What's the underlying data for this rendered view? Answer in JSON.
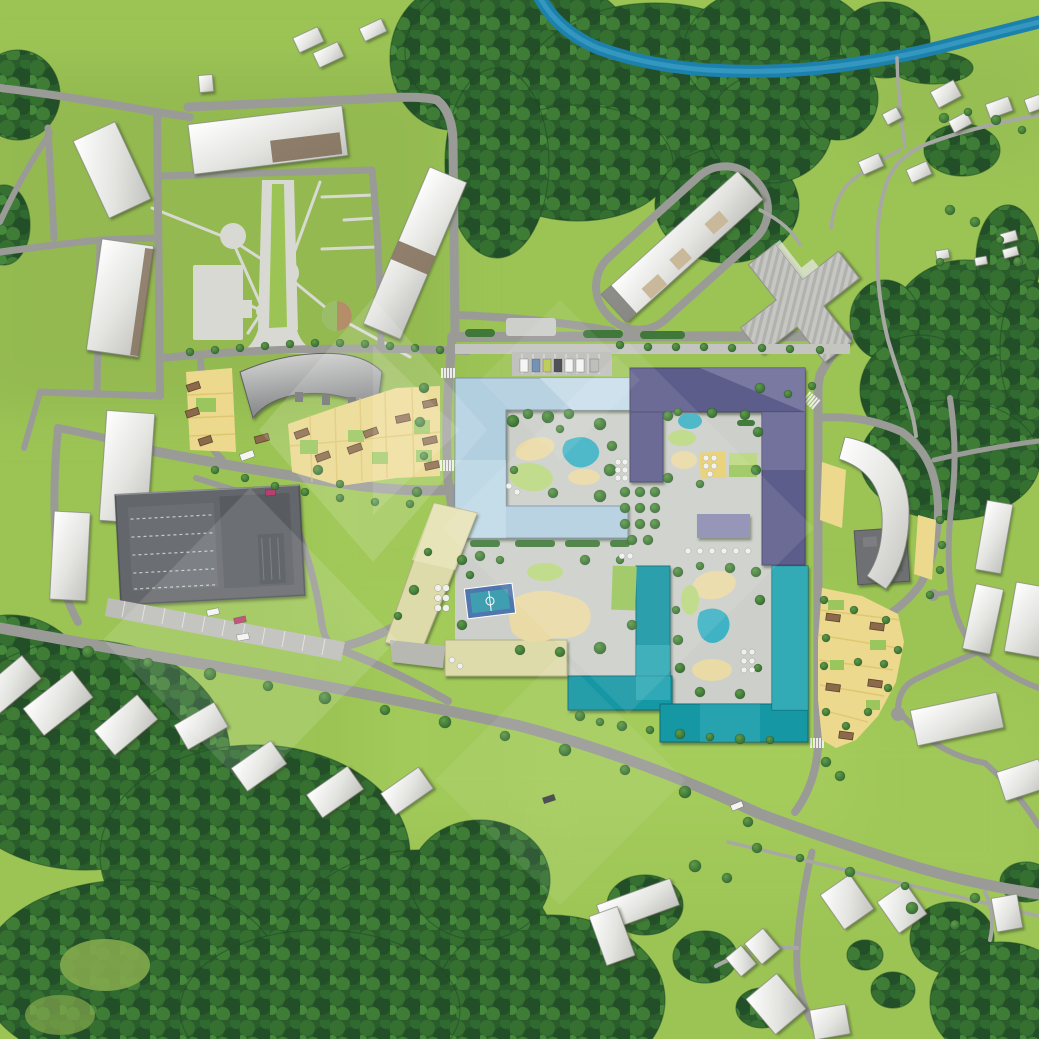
{
  "map": {
    "title": "residential-complex-masterplan-aerial-illustration",
    "text_labels": [],
    "palette": {
      "grass": "#9cc455",
      "grass_olive": "#8cb14e",
      "grass_bright": "#a9d05e",
      "meadow": "#83a84c",
      "forest": "#2b5c2c",
      "forest_dark": "#1f4a24",
      "tree": "#3f7d36",
      "hedge": "#3a7634",
      "river": "#1d81ae",
      "river_light": "#3fa3c8",
      "road": "#9a9b97",
      "lane": "#a7a8a4",
      "path": "#d8d9d3",
      "pavement": "#cdcfca",
      "sidewalk": "#c4c5c0",
      "apron": "#bcbdb9",
      "roof_white": "#eceded",
      "roof_edge": "#83847e",
      "roof_face": "#70716d",
      "roof_brown": "#7e6b55",
      "block_blue": "#b2cfe0",
      "block_blue_light": "#cadfeb",
      "block_purple": "#5d5d8b",
      "block_purple_light": "#8c8cb3",
      "block_teal": "#1297a4",
      "block_teal_light": "#54bfca",
      "block_yellow": "#dedbaa",
      "block_yellow_light": "#ece9c3",
      "wing_gray": "#b7b8b2",
      "townhouse": "#ecd98d",
      "townhouse_dark": "#dcc26c",
      "hut": "#8a6a4a",
      "hut_dark": "#5f452e",
      "garage": "#63666a",
      "garage_dark": "#4d5054",
      "garage_lines": "#c9cac6",
      "cross_building": "#c6c7c3",
      "cross_stripe": "#9fa09c",
      "school": "#6e7073",
      "pond": "#3fb2c4",
      "sand": "#e9daa6",
      "lawn": "#9ac65e",
      "lawn_light": "#bcd983",
      "play_yellow": "#e7cf6e",
      "court_blue": "#4f76ad",
      "court_teal": "#3f9fb0",
      "dot": "#f0f1ee",
      "car_white": "#f4f5f3",
      "car_dark": "#41434a",
      "car_blue": "#6a88b0",
      "car_lime": "#b9c94e",
      "car_red": "#b8406e",
      "car_gray": "#b9bab6",
      "watermark": "#ffffff"
    },
    "districts": {
      "new_residential_complex": {
        "blocks": [
          {
            "id": "north-block",
            "roof_color": "light-blue"
          },
          {
            "id": "east-block",
            "roof_color": "purple"
          },
          {
            "id": "south-block",
            "roof_color": "teal"
          },
          {
            "id": "west-block",
            "roof_color": "pale-yellow"
          }
        ],
        "courtyards": 4,
        "amenities": [
          "children-playground",
          "sand-pits",
          "ponds",
          "basketball-court",
          "tree-grid-plaza",
          "pergola-seating",
          "guest-parking-row"
        ]
      },
      "legacy_estate": {
        "buildings": [
          "arc-building",
          "six-slab-buildings",
          "park-with-circular-plazas",
          "promenade-allee"
        ],
        "townhouse_clusters": 2
      },
      "east_neighborhood": {
        "buildings": [
          "curved-slab-building",
          "townhouse-terraces",
          "flat-roof-school"
        ],
        "loop_road": true
      },
      "landmarks": [
        "cross-shaped-tower",
        "parking-garage",
        "river",
        "north-forest",
        "south-forest"
      ]
    },
    "counts": {
      "parked_cars_in_row": 7,
      "cars_on_roads": 6,
      "apron_cars": 2,
      "rooftop_car": 1,
      "ponds": 3,
      "sand_playgrounds": 6,
      "sports_courts": 2,
      "townhouse_huts": 18,
      "detached_houses_visible": 30
    },
    "environment": [
      "forest",
      "river",
      "meadows",
      "street-trees",
      "hedges"
    ],
    "overlay": {
      "type": "chevron-diamond-watermark",
      "color": "#ffffff",
      "opacity_range": [
        0.07,
        0.14
      ]
    }
  }
}
